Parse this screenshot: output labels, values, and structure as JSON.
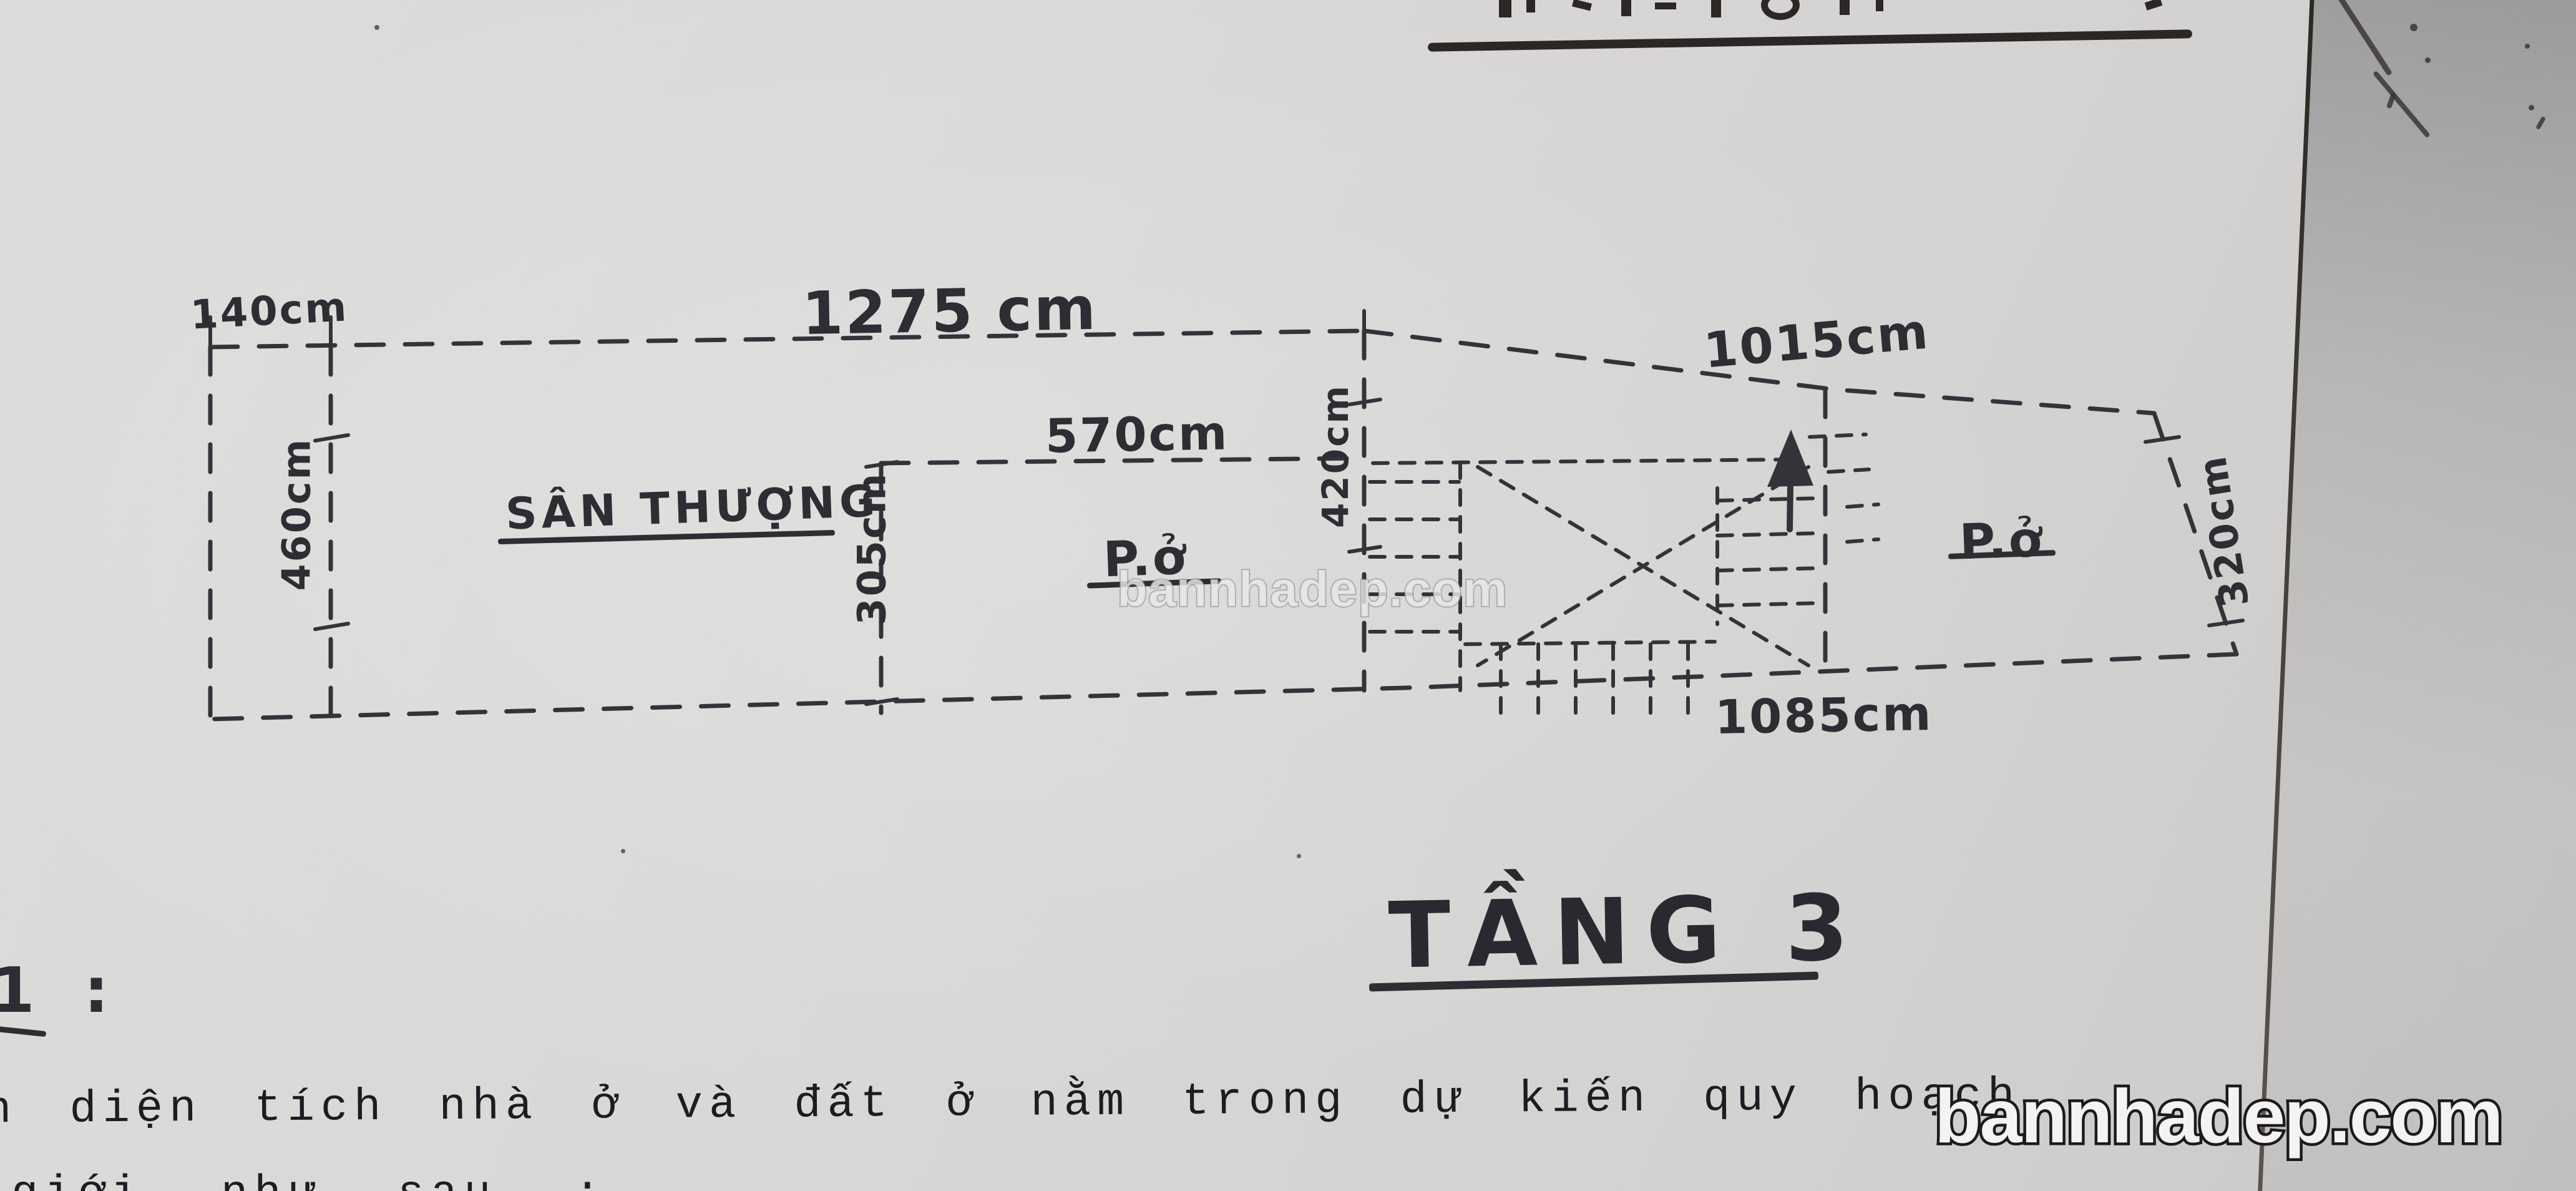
{
  "plan": {
    "title": "TẦNG 3",
    "rooms": {
      "terrace": "SÂN THƯỢNG",
      "left_room": "P.ở",
      "right_room": "P.ở"
    },
    "dims": {
      "setback_width": "140cm",
      "left_width": "1275 cm",
      "right_width": "1015cm",
      "middle_room_width": "570cm",
      "left_depth": "460cm",
      "middle_depth": "305cm",
      "stair_bay_depth": "420cm",
      "rear_width": "1085cm",
      "right_depth": "320cm"
    }
  },
  "notes": {
    "margin_ref": "1 :",
    "typed_line1": "n diện tích nhà ở và đất ở nằm trong dự kiến quy hoạch",
    "typed_line2": "giới như sau :"
  },
  "watermarks": {
    "center": "bannhadep.com",
    "corner": "bannhadep.com"
  },
  "colors": {
    "paper": "#d8d7d5",
    "ink": "#35333a",
    "typed_ink": "#1c1c22"
  }
}
